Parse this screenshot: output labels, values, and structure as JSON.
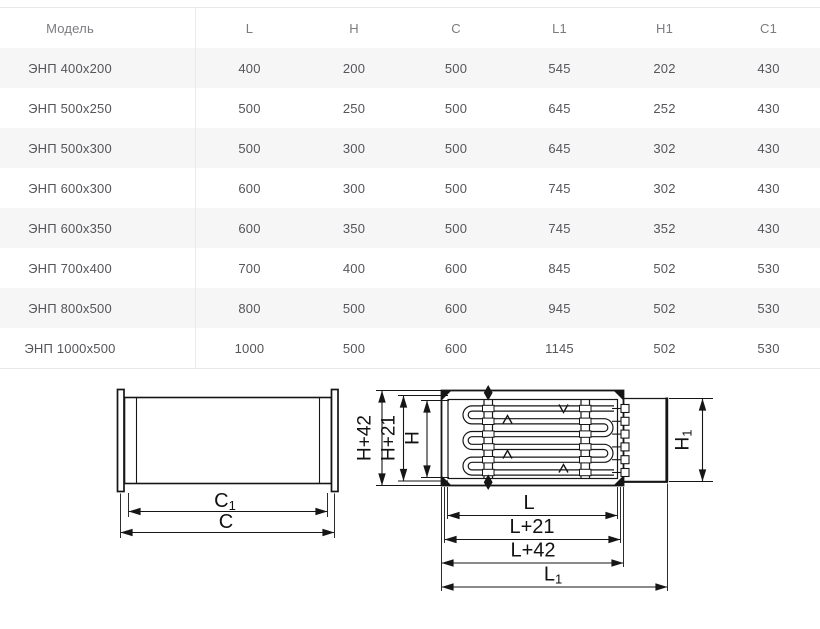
{
  "table": {
    "headers": [
      "Модель",
      "L",
      "H",
      "C",
      "L1",
      "H1",
      "C1"
    ],
    "rows": [
      [
        "ЭНП 400x200",
        "400",
        "200",
        "500",
        "545",
        "202",
        "430"
      ],
      [
        "ЭНП 500x250",
        "500",
        "250",
        "500",
        "645",
        "252",
        "430"
      ],
      [
        "ЭНП 500x300",
        "500",
        "300",
        "500",
        "645",
        "302",
        "430"
      ],
      [
        "ЭНП 600x300",
        "600",
        "300",
        "500",
        "745",
        "302",
        "430"
      ],
      [
        "ЭНП 600x350",
        "600",
        "350",
        "500",
        "745",
        "352",
        "430"
      ],
      [
        "ЭНП 700x400",
        "700",
        "400",
        "600",
        "845",
        "502",
        "530"
      ],
      [
        "ЭНП 800x500",
        "800",
        "500",
        "600",
        "945",
        "502",
        "530"
      ],
      [
        "ЭНП 1000x500",
        "1000",
        "500",
        "600",
        "1145",
        "502",
        "530"
      ]
    ]
  },
  "drawing": {
    "line_color": "#161616",
    "side_view": {
      "dim_c1": {
        "base": "C",
        "sub": "1"
      },
      "dim_c": "C"
    },
    "front_view": {
      "dim_h42": "H+42",
      "dim_h21": "H+21",
      "dim_h": "H",
      "dim_h1": {
        "base": "H",
        "sub": "1"
      },
      "dim_l": "L",
      "dim_l21": "L+21",
      "dim_l42": "L+42",
      "dim_l1": {
        "base": "L",
        "sub": "1"
      }
    }
  }
}
